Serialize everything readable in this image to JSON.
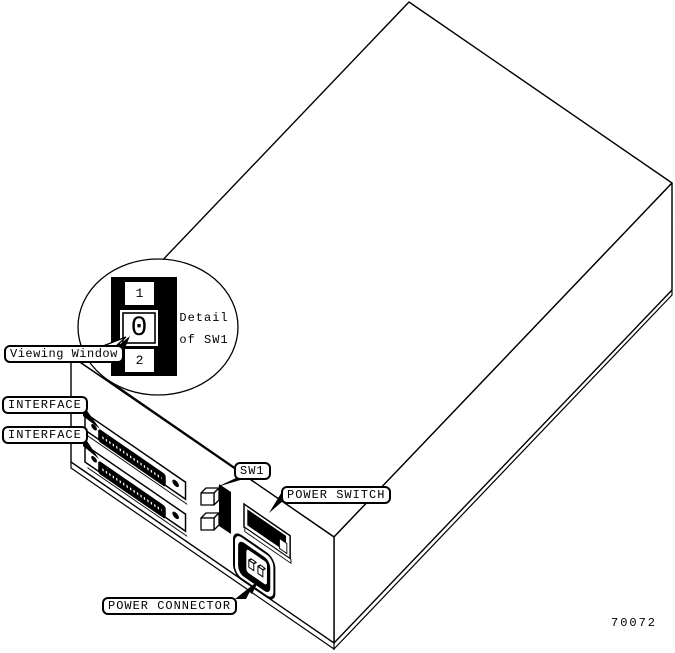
{
  "figure": {
    "number": "70072",
    "detail_caption": {
      "line1": "Detail",
      "line2": "of SW1"
    }
  },
  "labels": {
    "viewing_window": "Viewing Window",
    "interface_top": "INTERFACE",
    "interface_bottom": "INTERFACE",
    "sw1": "SW1",
    "power_switch": "POWER SWITCH",
    "power_connector": "POWER CONNECTOR"
  },
  "sw1_detail": {
    "top": "1",
    "middle": "0",
    "bottom": "2"
  },
  "colors": {
    "line": "#000000",
    "background": "#ffffff"
  }
}
